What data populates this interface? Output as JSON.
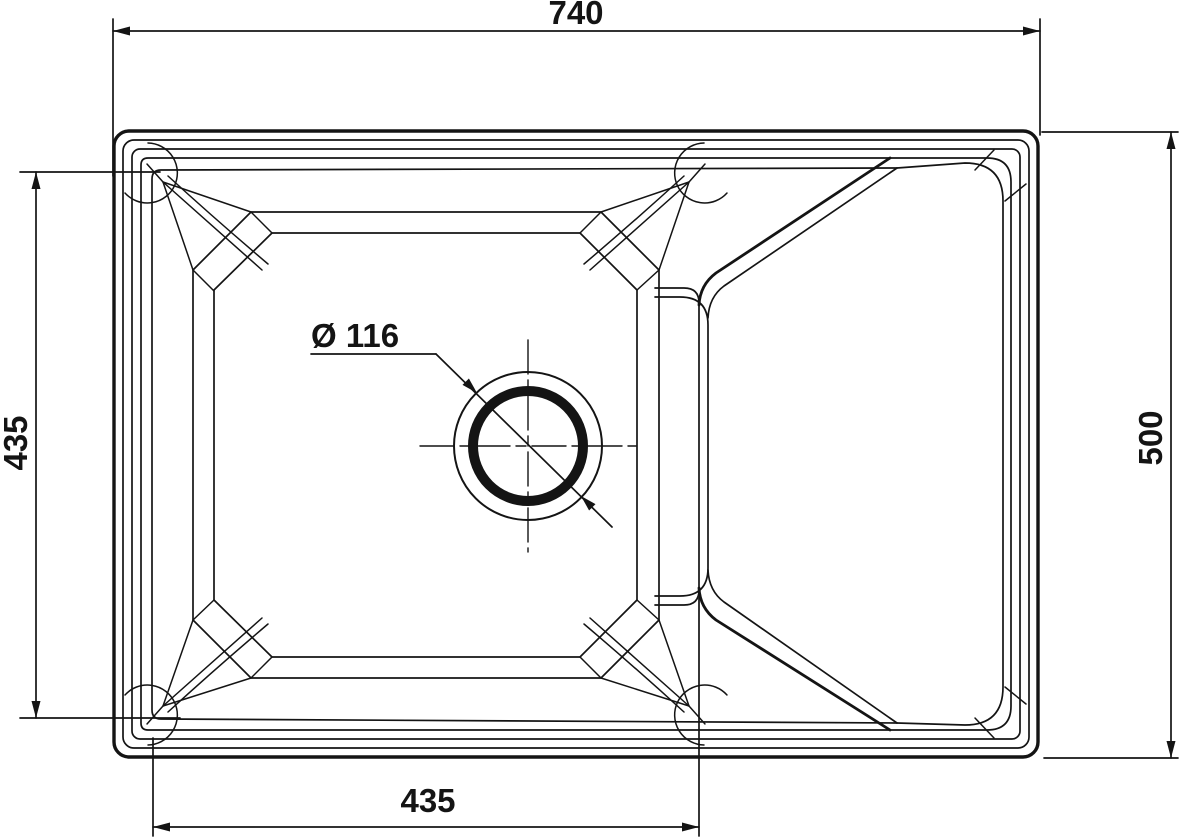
{
  "drawing": {
    "type": "technical-drawing",
    "subject": "kitchen sink top view with single bowl and drainer",
    "background_color": "#ffffff",
    "line_color": "#141414",
    "dimensions": {
      "overall_width": {
        "label": "740",
        "orientation": "horizontal-top"
      },
      "overall_depth": {
        "label": "500",
        "orientation": "vertical-right"
      },
      "bowl_depth": {
        "label": "435",
        "orientation": "vertical-left"
      },
      "bowl_width": {
        "label": "435",
        "orientation": "horizontal-bottom"
      },
      "drain_diameter": {
        "label": "Ø 116",
        "orientation": "leader"
      }
    }
  }
}
